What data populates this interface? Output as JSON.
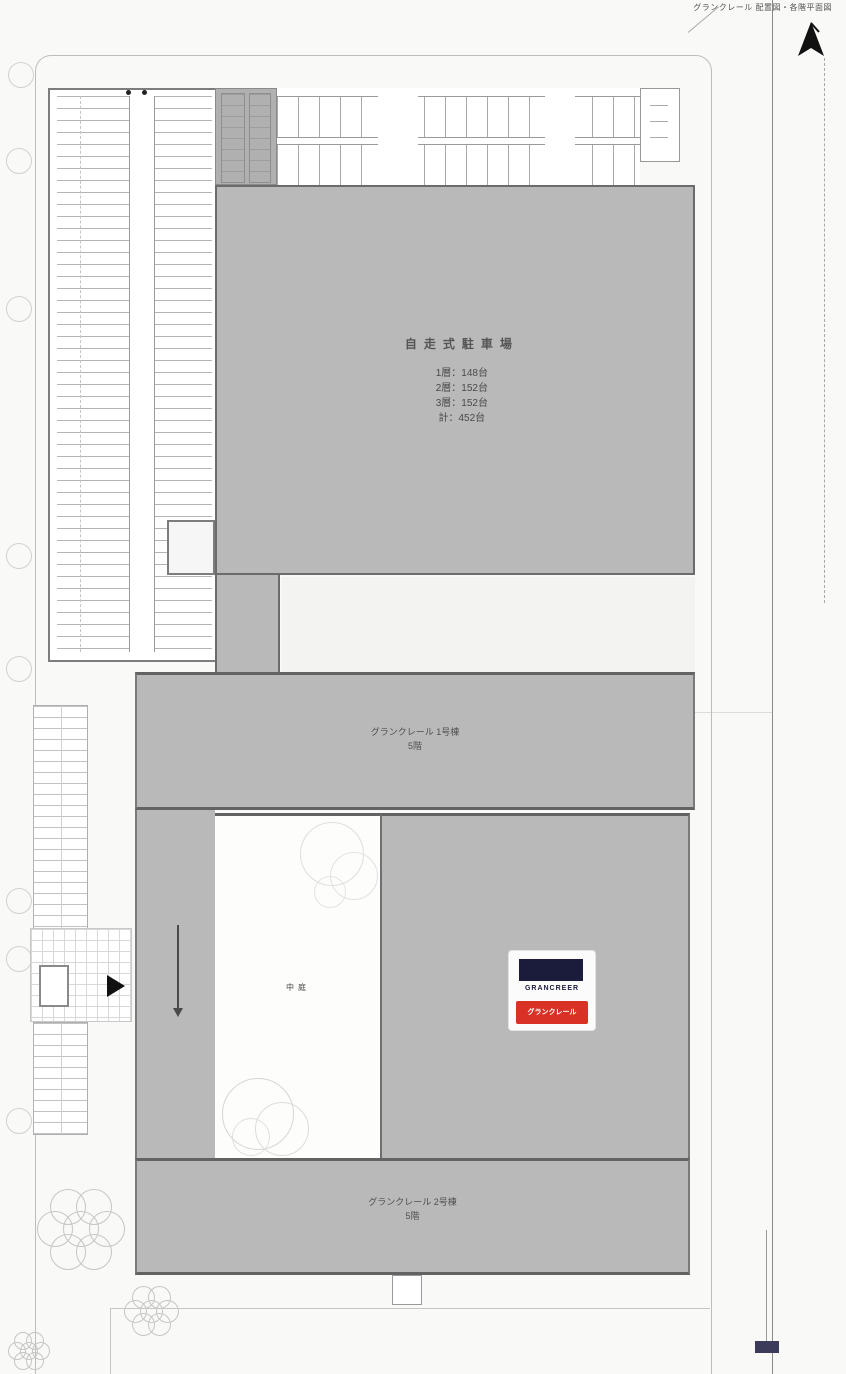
{
  "caption": "グランクレール 配置図・各階平面図",
  "colors": {
    "building_fill": "#b9b9b9",
    "logo_navy": "#1b1b3c",
    "logo_red": "#da3126",
    "arrow_black": "#111111",
    "survey_navy": "#3c3c5a"
  },
  "garage_legend": {
    "title": "自走式駐車場",
    "rows": [
      {
        "label": "1層",
        "sep": "：",
        "value": "148台"
      },
      {
        "label": "2層",
        "sep": "：",
        "value": "152台"
      },
      {
        "label": "3層",
        "sep": "：",
        "value": "152台"
      },
      {
        "label": "計",
        "sep": "：",
        "value": "452台"
      }
    ]
  },
  "building1": {
    "line1": "グランクレール 1号棟",
    "line2": "5階"
  },
  "building2": {
    "line1": "グランクレール 2号棟",
    "line2": "5階"
  },
  "courtyard_label": "中庭",
  "logo": {
    "wordmark": "GRANCREER",
    "banner": "グランクレール"
  }
}
